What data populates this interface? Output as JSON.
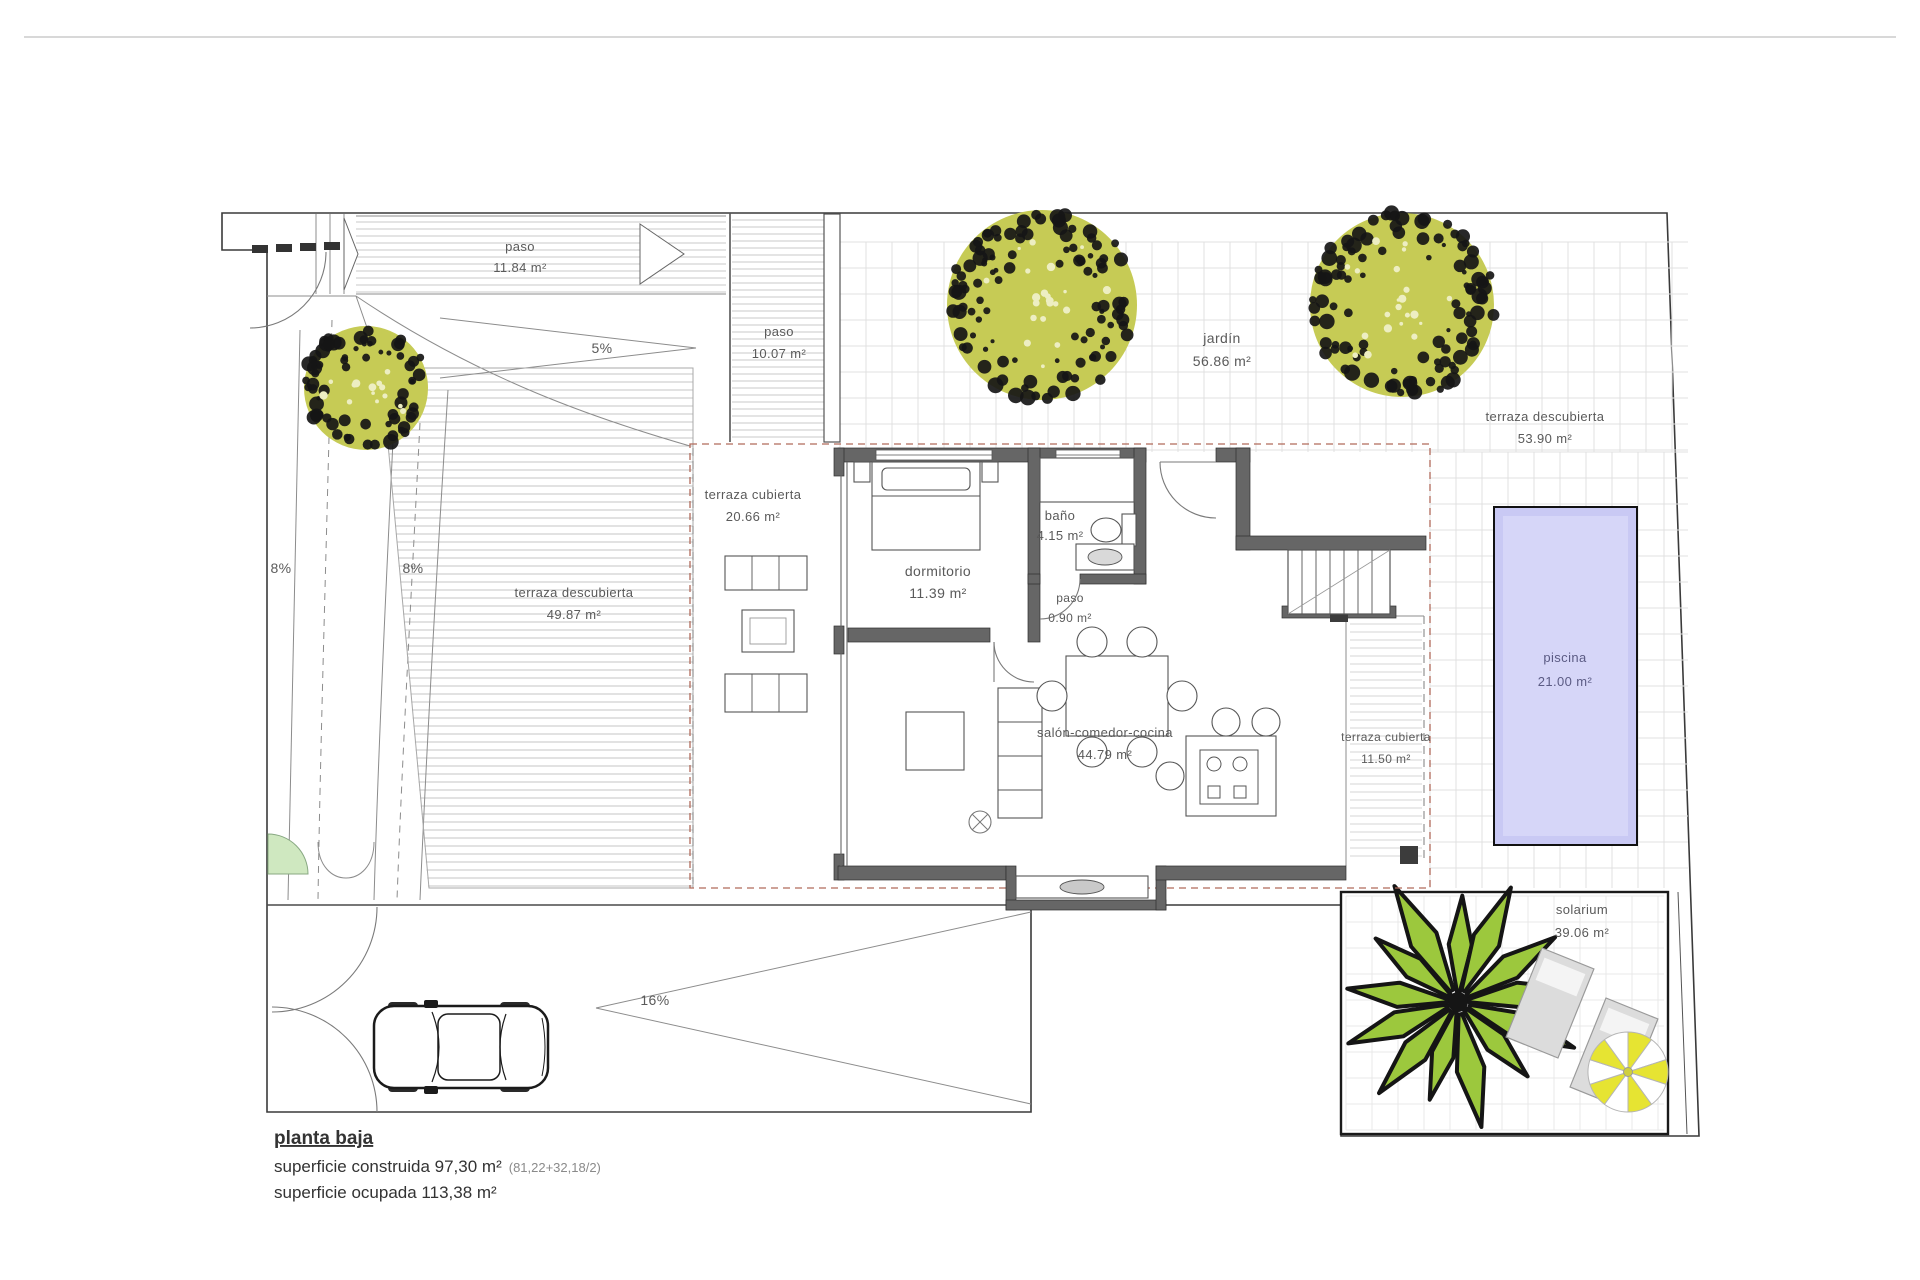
{
  "plan": {
    "rooms": {
      "paso_top": {
        "name": "paso",
        "area": "11.84 m²"
      },
      "paso_corridor": {
        "name": "paso",
        "area": "10.07 m²"
      },
      "jardin": {
        "name": "jardín",
        "area": "56.86 m²"
      },
      "terraza_descubierta_este": {
        "name": "terraza descubierta",
        "area": "53.90 m²"
      },
      "terraza_cubierta_oeste": {
        "name": "terraza cubierta",
        "area": "20.66 m²"
      },
      "dormitorio": {
        "name": "dormitorio",
        "area": "11.39 m²"
      },
      "bano": {
        "name": "baño",
        "area": "4.15 m²"
      },
      "paso_interior": {
        "name": "paso",
        "area": "0.90 m²"
      },
      "terraza_descubierta_oeste": {
        "name": "terraza descubierta",
        "area": "49.87 m²"
      },
      "salon": {
        "name": "salón-comedor-cocina",
        "area": "44.79 m²"
      },
      "terraza_cubierta_este": {
        "name": "terraza cubierta",
        "area": "11.50 m²"
      },
      "piscina": {
        "name": "piscina",
        "area": "21.00 m²"
      },
      "solarium": {
        "name": "solarium",
        "area": "39.06 m²"
      }
    },
    "slopes": {
      "ramp_entrance": "5%",
      "ramp_left_a": "8%",
      "ramp_left_b": "8%",
      "ramp_garage": "16%"
    },
    "title_block": {
      "floor_name": "planta baja",
      "built_area_label": "superficie construida 97,30 m²",
      "built_area_note": "(81,22+32,18/2)",
      "occupied_area_label": "superficie ocupada 113,38 m²"
    },
    "colors": {
      "tree_fill": "#c6cb55",
      "tree_dot": "#161616",
      "palm_fill": "#9cc83d",
      "pool_fill": "#c9c9f4",
      "pool_inner": "#dadafa",
      "grass_fill": "#cfe8c0",
      "parasol_yellow": "#e6e432"
    }
  }
}
